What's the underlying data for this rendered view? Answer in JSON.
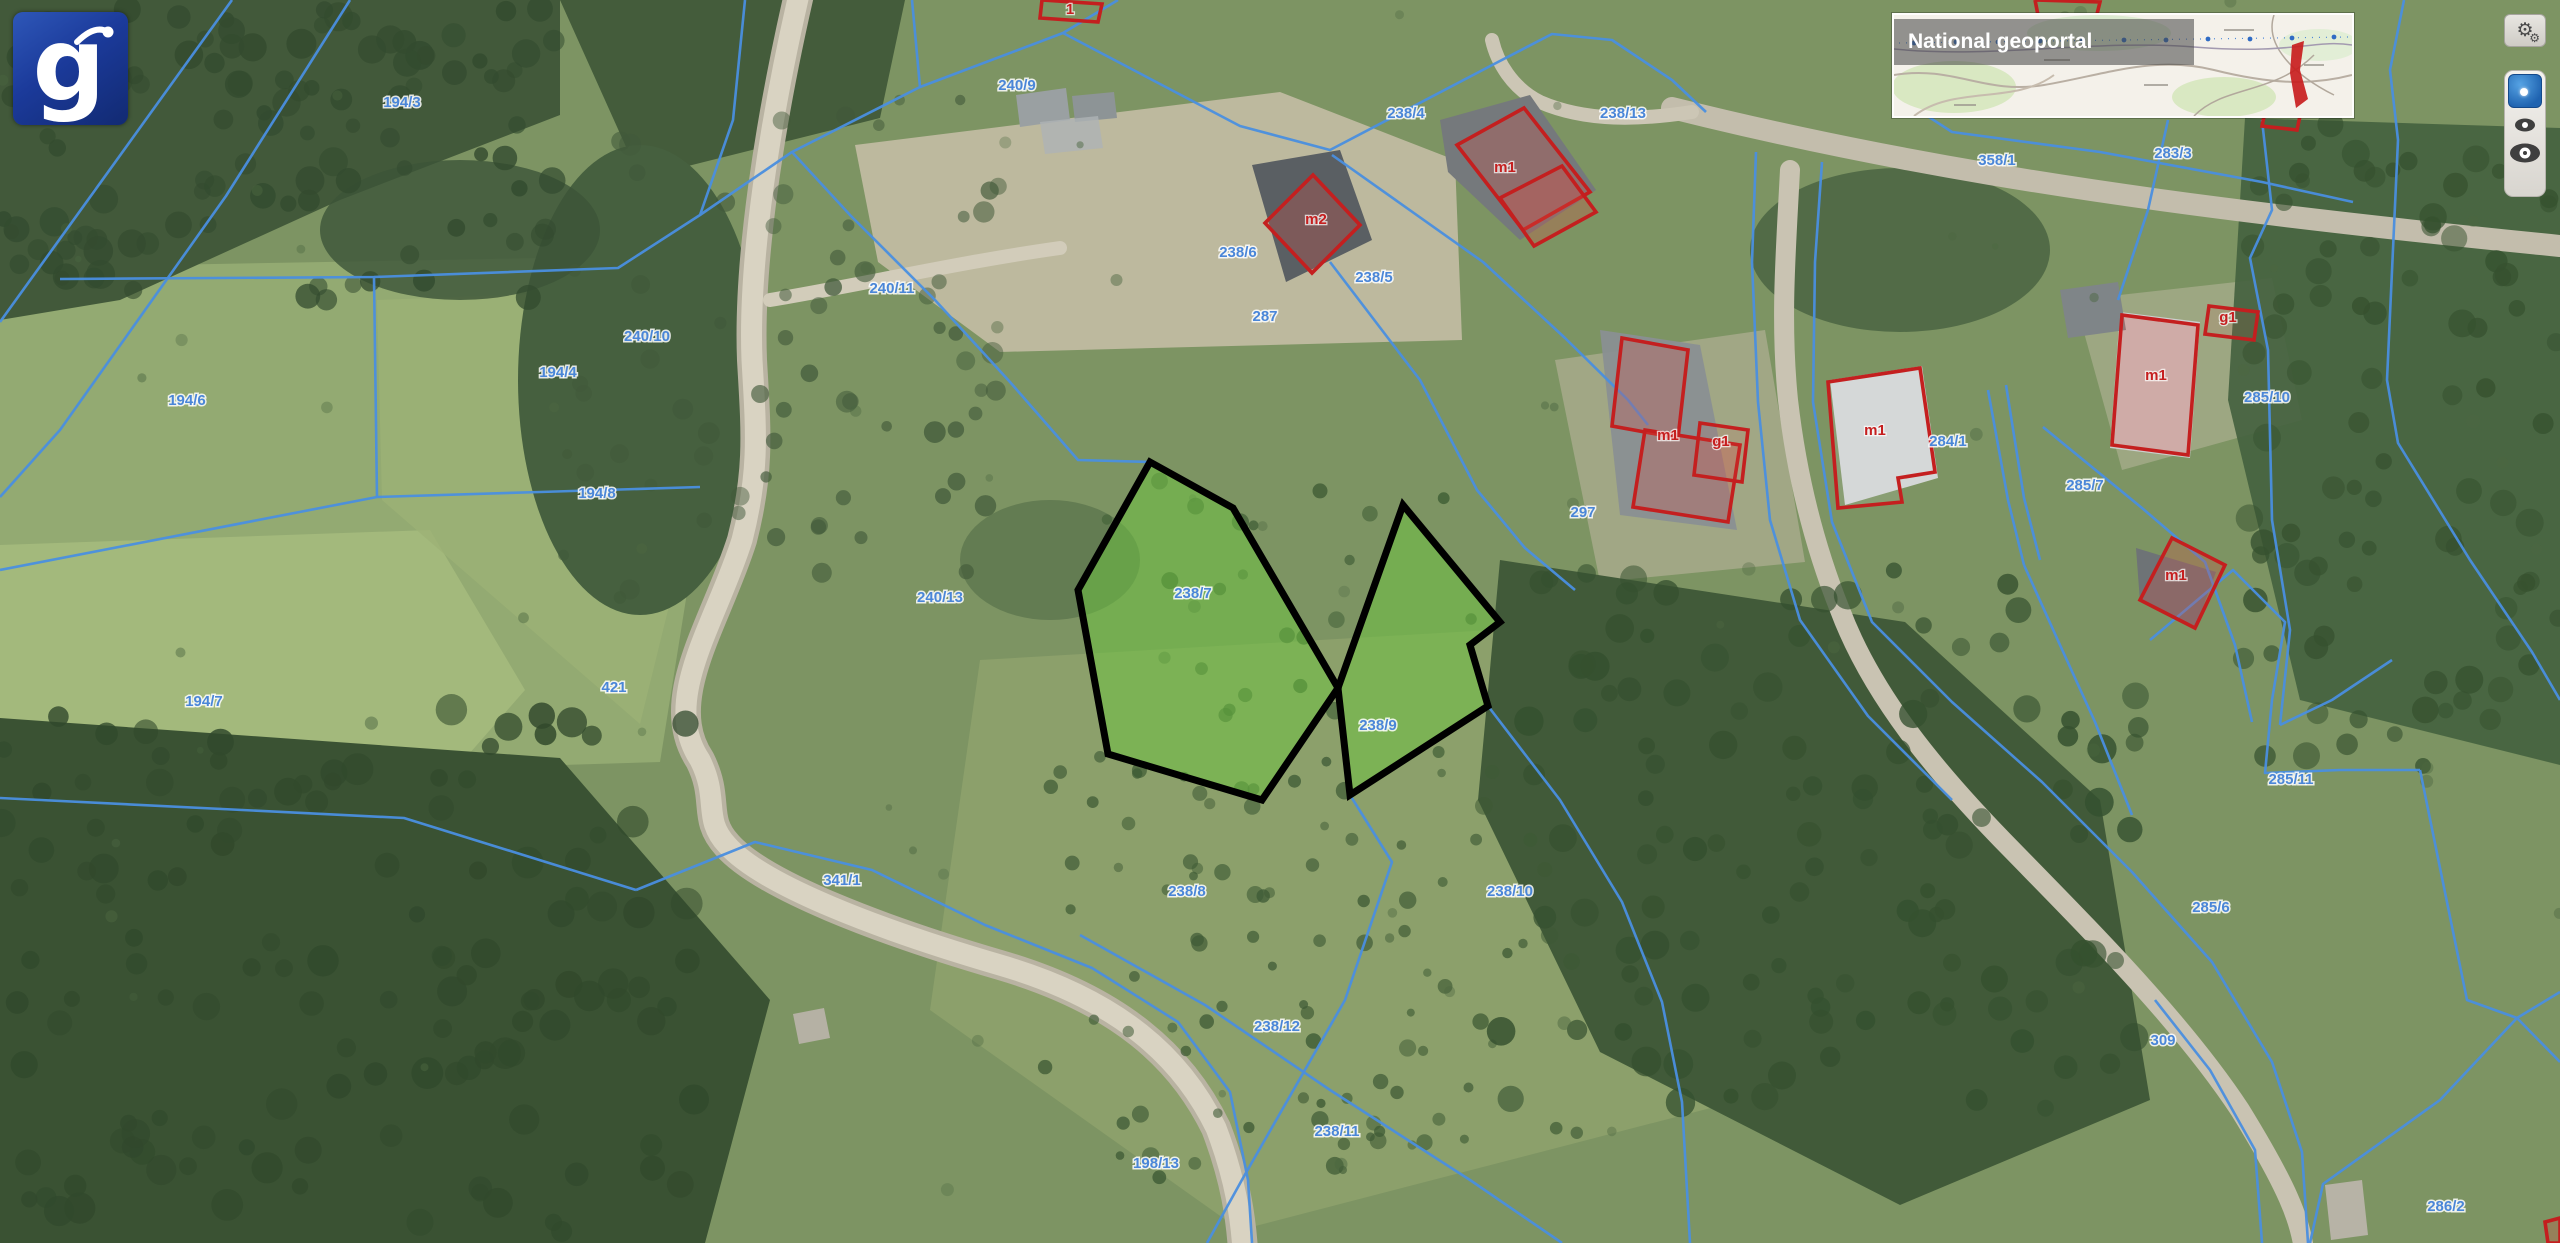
{
  "logo": {
    "glyph": "g"
  },
  "overview_map": {
    "title": "National geoportal"
  },
  "controls": {
    "settings": {
      "icon": "gears",
      "tooltip": "settings"
    },
    "marker": {
      "icon": "blue-dot"
    },
    "eye_small": {
      "icon": "eye"
    },
    "eye_large": {
      "icon": "eye"
    }
  },
  "map": {
    "colors": {
      "parcel_line": "#4a8fe0",
      "parcel_label": "#4a86d8",
      "building_outline": "#c41f1f",
      "building_label": "#c51f1f",
      "highlight_outline": "#000000",
      "highlight_fill": "rgba(110,195,65,0.52)"
    },
    "highlighted_parcels": [
      {
        "id": "238/7",
        "points": "1150,462 1233,508 1338,688 1262,800 1108,754 1078,590",
        "label_x": 1193,
        "label_y": 598
      },
      {
        "id": "238/9",
        "points": "1403,505 1500,622 1470,645 1488,706 1350,795 1338,688",
        "label_x": 1378,
        "label_y": 730
      }
    ],
    "parcel_labels": [
      {
        "t": "194/3",
        "x": 402,
        "y": 107
      },
      {
        "t": "240/9",
        "x": 1017,
        "y": 90
      },
      {
        "t": "238/4",
        "x": 1406,
        "y": 118
      },
      {
        "t": "238/13",
        "x": 1623,
        "y": 118
      },
      {
        "t": "358/1",
        "x": 1997,
        "y": 165
      },
      {
        "t": "283/3",
        "x": 2173,
        "y": 158
      },
      {
        "t": "238/6",
        "x": 1238,
        "y": 257
      },
      {
        "t": "238/5",
        "x": 1374,
        "y": 282
      },
      {
        "t": "240/11",
        "x": 892,
        "y": 293
      },
      {
        "t": "287",
        "x": 1265,
        "y": 321
      },
      {
        "t": "240/10",
        "x": 647,
        "y": 341
      },
      {
        "t": "194/4",
        "x": 558,
        "y": 377
      },
      {
        "t": "194/6",
        "x": 187,
        "y": 405
      },
      {
        "t": "285/10",
        "x": 2267,
        "y": 402
      },
      {
        "t": "284/1",
        "x": 1948,
        "y": 446
      },
      {
        "t": "285/7",
        "x": 2085,
        "y": 490
      },
      {
        "t": "194/8",
        "x": 597,
        "y": 498
      },
      {
        "t": "297",
        "x": 1583,
        "y": 517
      },
      {
        "t": "240/13",
        "x": 940,
        "y": 602
      },
      {
        "t": "421",
        "x": 614,
        "y": 692
      },
      {
        "t": "194/7",
        "x": 204,
        "y": 706
      },
      {
        "t": "285/11",
        "x": 2291,
        "y": 784
      },
      {
        "t": "341/1",
        "x": 842,
        "y": 885
      },
      {
        "t": "238/8",
        "x": 1187,
        "y": 896
      },
      {
        "t": "238/10",
        "x": 1510,
        "y": 896
      },
      {
        "t": "285/6",
        "x": 2211,
        "y": 912
      },
      {
        "t": "238/12",
        "x": 1277,
        "y": 1031
      },
      {
        "t": "309",
        "x": 2163,
        "y": 1045
      },
      {
        "t": "238/11",
        "x": 1337,
        "y": 1136
      },
      {
        "t": "198/13",
        "x": 1156,
        "y": 1168
      },
      {
        "t": "286/2",
        "x": 2446,
        "y": 1211
      }
    ],
    "building_labels": [
      {
        "t": "m1",
        "x": 1505,
        "y": 172
      },
      {
        "t": "m2",
        "x": 1316,
        "y": 224
      },
      {
        "t": "g1",
        "x": 2228,
        "y": 322
      },
      {
        "t": "m1",
        "x": 2156,
        "y": 380
      },
      {
        "t": "m1",
        "x": 1668,
        "y": 440
      },
      {
        "t": "g1",
        "x": 1721,
        "y": 446
      },
      {
        "t": "m1",
        "x": 1875,
        "y": 435
      },
      {
        "t": "m1",
        "x": 2176,
        "y": 580
      },
      {
        "t": "1",
        "x": 1070,
        "y": 14
      }
    ]
  }
}
